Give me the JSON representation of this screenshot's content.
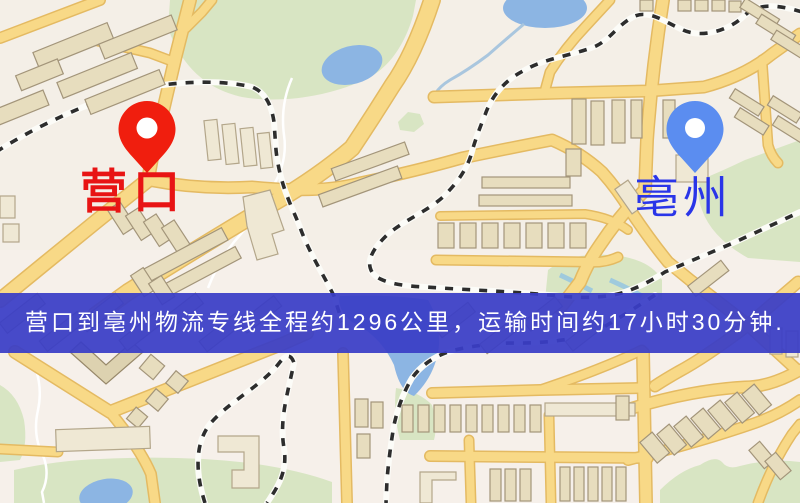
{
  "map": {
    "origin": {
      "label": "营口",
      "label_color": "#e81414",
      "pin_color": "#f01e0e",
      "pin_icon": "red-map-pin"
    },
    "destination": {
      "label": "亳州",
      "label_color": "#2a35e8",
      "pin_color": "#5b8df0",
      "pin_icon": "blue-map-pin"
    },
    "banner": {
      "text": "营口到亳州物流专线全程约1296公里，运输时间约17小时30分钟.",
      "background_color": "rgba(58,62,198,0.74)",
      "text_color": "#ffffff"
    }
  },
  "palette": {
    "map_background": "#f4efe7",
    "road_fill": "#f8d987",
    "road_casing": "#e4ba62",
    "park_green": "#d8e5c3",
    "water_blue": "#8cb5e3",
    "pond_teal": "#84b6c6",
    "railway_dark": "#2d2d2d",
    "building_fill": "#e7ddbe"
  }
}
